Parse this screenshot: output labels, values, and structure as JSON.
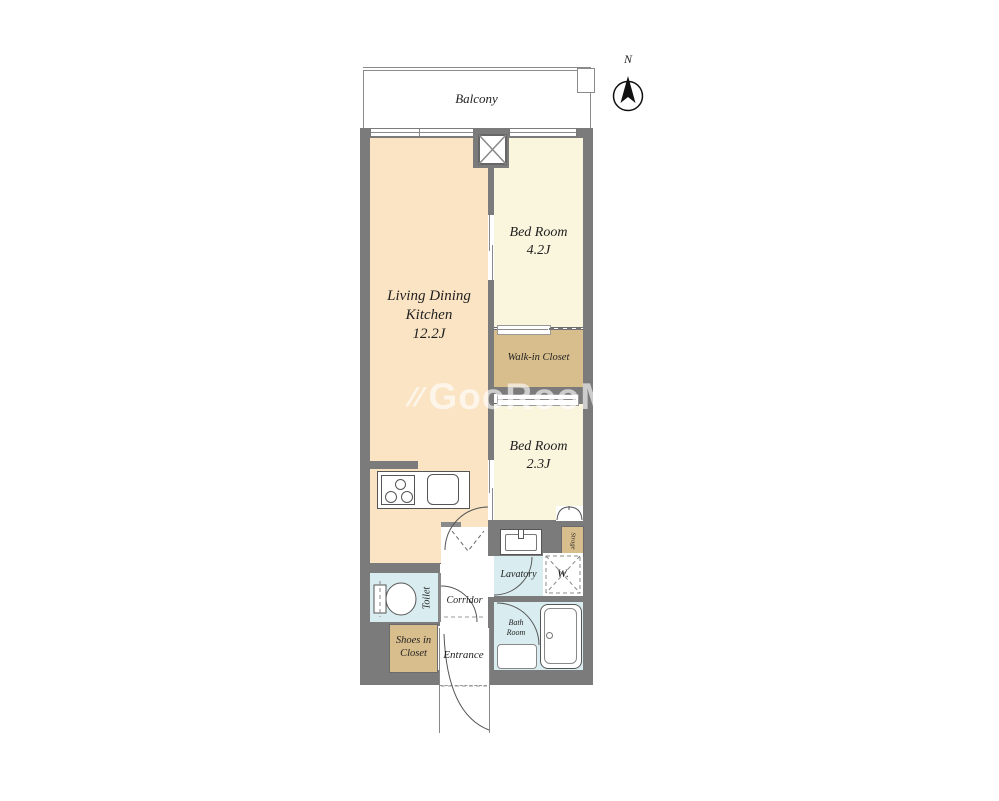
{
  "palette": {
    "wall": "#7b7b7b",
    "room_ldk": "#fae4c4",
    "room_bedroom": "#faf5dd",
    "room_closet": "#d9be8d",
    "room_wet": "#d9edf0",
    "line": "#555555",
    "text": "#1f1f1f"
  },
  "compass": {
    "label": "N"
  },
  "balcony": {
    "label": "Balcony"
  },
  "watermark": {
    "icon": "//",
    "text": "GooRooM"
  },
  "rooms": {
    "ldk": {
      "name_line1": "Living Dining",
      "name_line2": "Kitchen",
      "size": "12.2J"
    },
    "bedroom_42": {
      "name": "Bed Room",
      "size": "4.2J"
    },
    "bedroom_23": {
      "name": "Bed Room",
      "size": "2.3J"
    },
    "walk_in_closet": {
      "name": "Walk-in Closet"
    },
    "lavatory": {
      "name": "Lavatory"
    },
    "toilet": {
      "name": "Toilet"
    },
    "corridor": {
      "name": "Corridor"
    },
    "entrance": {
      "name": "Entrance"
    },
    "shoes_in_closet": {
      "name_line1": "Shoes in",
      "name_line2": "Closet"
    },
    "bath": {
      "name_line1": "Bath",
      "name_line2": "Room"
    },
    "washer": {
      "label": "W."
    },
    "storage": {
      "name": "Strage"
    }
  }
}
